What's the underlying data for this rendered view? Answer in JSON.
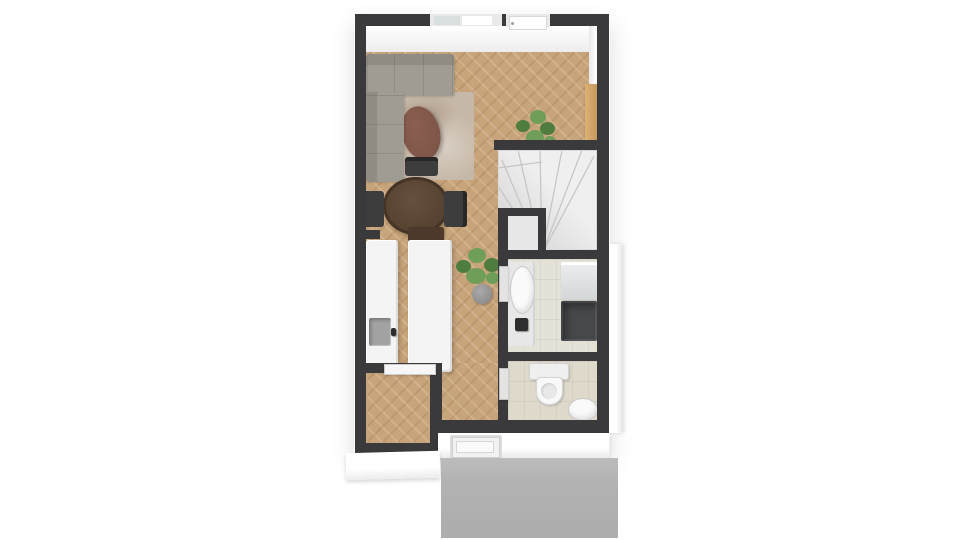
{
  "image": {
    "kind": "3d-floor-plan",
    "view": "top-down",
    "width_px": 960,
    "height_px": 540
  },
  "colors": {
    "background": "#ffffff",
    "wall": "#3a3a3c",
    "wood": "#c7a47a",
    "stairsFloor": "#efefef",
    "closetFloor": "#e7e7e7",
    "stepLine": "#c6c6c6",
    "bathFloor": "#e4e1d7",
    "toiletFloor": "#ded9cb",
    "counter": "#f4f4f4",
    "counterEdge": "#dcdcdc",
    "sinkGray": "#a2a2a2",
    "sofa": "#a09c93",
    "rug": "#c6b8a8",
    "pouf": "#7a5245",
    "table": "#55402f",
    "tableRim": "#463426",
    "chair": "#3d3d3d",
    "chairBrown": "#4c392b",
    "cabinet": "#c99c62",
    "plant": "#6f9e58",
    "plantDark": "#4f7d3f",
    "pot": "#8f8f8f",
    "windowPane": "#ffffff",
    "windowPaneAlt": "#d9dedf",
    "frame": "#e9e9e9",
    "applianceLight": "#d3d6d8",
    "applianceDark": "#47494c",
    "porcelain": "#fafafa",
    "pavement": "#b2b2b2",
    "doorWhite": "#f6f6f6"
  },
  "rooms": [
    "living-room",
    "dining-area",
    "kitchen",
    "hallway",
    "staircase",
    "under-stair-closet",
    "bathroom",
    "toilet-room",
    "storage-room",
    "entrance"
  ],
  "objects": [
    "corner-sofa",
    "area-rug",
    "pouf",
    "tall-cabinet",
    "potted-plant-living",
    "potted-plant-hall",
    "dining-table",
    "dining-chair-top",
    "dining-chair-left",
    "dining-chair-right",
    "dining-chair-bottom",
    "kitchen-counter",
    "kitchen-sink",
    "kitchen-island",
    "winder-staircase",
    "bathroom-vanity",
    "bathroom-basin",
    "bathroom-faucet",
    "washing-machine",
    "dryer",
    "toilet",
    "hand-basin",
    "window",
    "balcony-door",
    "storage-door",
    "front-door",
    "paved-entrance"
  ]
}
